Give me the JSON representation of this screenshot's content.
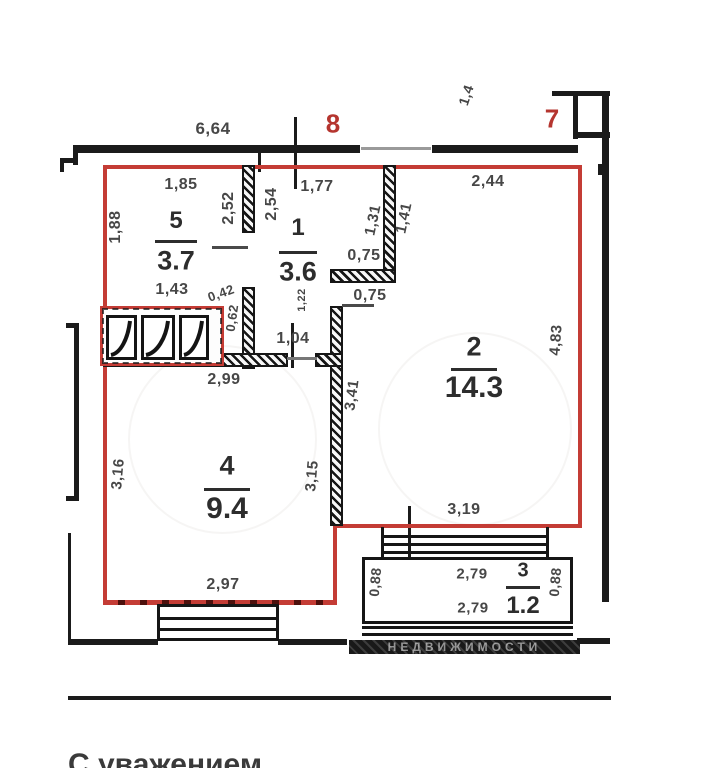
{
  "plan_title": "apartment-floor-plan",
  "colors": {
    "outline_red": "#c43c35",
    "wall_black": "#1b1b1b",
    "dim_text": "#474747",
    "axis_red": "#b5352f"
  },
  "axis_markers": [
    {
      "label": "8",
      "x": 333,
      "y": 124
    },
    {
      "label": "7",
      "x": 552,
      "y": 119
    }
  ],
  "rooms": [
    {
      "num": "5",
      "area": "3.7",
      "cx": 176,
      "num_y": 221,
      "line_y": 240,
      "line_w": 42,
      "area_y": 261,
      "num_s": 24,
      "area_s": 27
    },
    {
      "num": "1",
      "area": "3.6",
      "cx": 298,
      "num_y": 228,
      "line_y": 251,
      "line_w": 38,
      "area_y": 272,
      "num_s": 24,
      "area_s": 27
    },
    {
      "num": "2",
      "area": "14.3",
      "cx": 474,
      "num_y": 347,
      "line_y": 368,
      "line_w": 46,
      "area_y": 388,
      "num_s": 27,
      "area_s": 30
    },
    {
      "num": "4",
      "area": "9.4",
      "cx": 227,
      "num_y": 466,
      "line_y": 488,
      "line_w": 46,
      "area_y": 509,
      "num_s": 27,
      "area_s": 30
    },
    {
      "num": "3",
      "area": "1.2",
      "cx": 523,
      "num_y": 571,
      "line_y": 586,
      "line_w": 34,
      "area_y": 606,
      "num_s": 20,
      "area_s": 24
    }
  ],
  "dimensions": [
    {
      "t": "6,64",
      "x": 213,
      "y": 129,
      "r": 0,
      "s": 17
    },
    {
      "t": "1,4",
      "x": 466,
      "y": 95,
      "r": -72,
      "s": 14
    },
    {
      "t": "1,85",
      "x": 181,
      "y": 185,
      "r": 0,
      "s": 16
    },
    {
      "t": "2,52",
      "x": 229,
      "y": 208,
      "r": -90,
      "s": 16
    },
    {
      "t": "2,54",
      "x": 272,
      "y": 204,
      "r": -90,
      "s": 16
    },
    {
      "t": "1,77",
      "x": 317,
      "y": 187,
      "r": 0,
      "s": 16
    },
    {
      "t": "2,44",
      "x": 488,
      "y": 182,
      "r": 0,
      "s": 16
    },
    {
      "t": "1,41",
      "x": 404,
      "y": 218,
      "r": -78,
      "s": 15
    },
    {
      "t": "1,31",
      "x": 373,
      "y": 220,
      "r": -78,
      "s": 15
    },
    {
      "t": "1,88",
      "x": 116,
      "y": 227,
      "r": -90,
      "s": 16
    },
    {
      "t": "0,75",
      "x": 364,
      "y": 256,
      "r": 0,
      "s": 16
    },
    {
      "t": "0,75",
      "x": 370,
      "y": 296,
      "r": 0,
      "s": 16
    },
    {
      "t": "1,43",
      "x": 172,
      "y": 290,
      "r": 0,
      "s": 16
    },
    {
      "t": "0,42",
      "x": 221,
      "y": 293,
      "r": -20,
      "s": 13
    },
    {
      "t": "0,62",
      "x": 232,
      "y": 318,
      "r": -82,
      "s": 13
    },
    {
      "t": "1,22",
      "x": 302,
      "y": 300,
      "r": -90,
      "s": 11
    },
    {
      "t": "1,04",
      "x": 293,
      "y": 339,
      "r": 0,
      "s": 16
    },
    {
      "t": "2,99",
      "x": 224,
      "y": 380,
      "r": 0,
      "s": 16
    },
    {
      "t": "3,41",
      "x": 352,
      "y": 395,
      "r": -82,
      "s": 15
    },
    {
      "t": "3,16",
      "x": 118,
      "y": 474,
      "r": -85,
      "s": 15
    },
    {
      "t": "3,15",
      "x": 312,
      "y": 476,
      "r": -85,
      "s": 15
    },
    {
      "t": "4,83",
      "x": 556,
      "y": 340,
      "r": -86,
      "s": 15
    },
    {
      "t": "3,19",
      "x": 464,
      "y": 510,
      "r": 0,
      "s": 16
    },
    {
      "t": "2,97",
      "x": 223,
      "y": 585,
      "r": 0,
      "s": 16
    },
    {
      "t": "0,88",
      "x": 375,
      "y": 582,
      "r": -85,
      "s": 14
    },
    {
      "t": "2,79",
      "x": 472,
      "y": 574,
      "r": 0,
      "s": 15
    },
    {
      "t": "2,79",
      "x": 473,
      "y": 608,
      "r": 0,
      "s": 15
    },
    {
      "t": "0,88",
      "x": 555,
      "y": 582,
      "r": -85,
      "s": 14
    }
  ],
  "watermark": {
    "strip_text": "НЕДВИЖИМОСТИ"
  },
  "bottom_note": "С уважением"
}
